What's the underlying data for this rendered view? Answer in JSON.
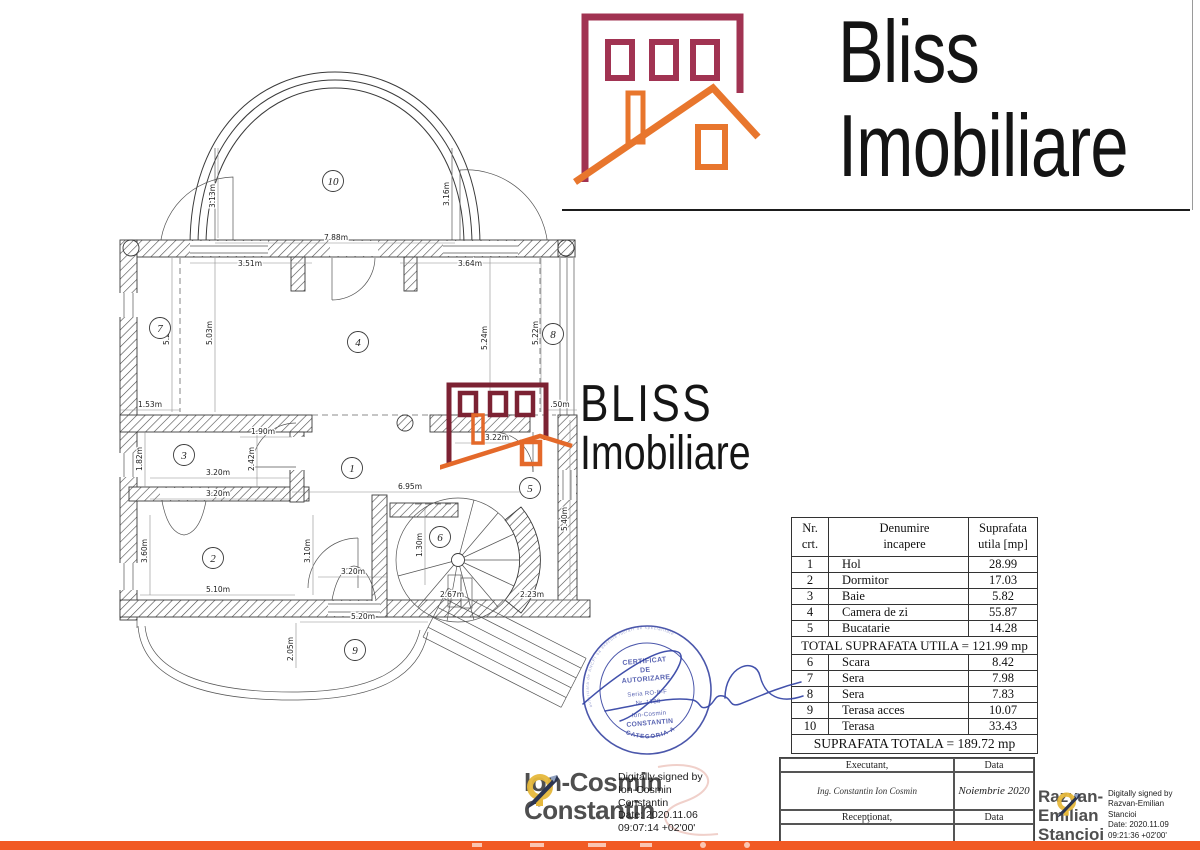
{
  "colors": {
    "maroon": "#a13352",
    "maroon_dark": "#7c2233",
    "orange": "#e8762d",
    "orange_dark": "#e4692a",
    "footer": "#f15a24",
    "stamp_blue": "#3340a0",
    "ink": "#2e3fa3"
  },
  "brand": {
    "line1": "Bliss",
    "line2": "Imobiliare"
  },
  "watermark": {
    "line1": "BLISS",
    "line2": "Imobiliare"
  },
  "floorplan": {
    "rooms": [
      {
        "n": "10",
        "x": 333,
        "y": 181
      },
      {
        "n": "7",
        "x": 160,
        "y": 328
      },
      {
        "n": "4",
        "x": 358,
        "y": 342
      },
      {
        "n": "8",
        "x": 553,
        "y": 334
      },
      {
        "n": "3",
        "x": 184,
        "y": 455
      },
      {
        "n": "1",
        "x": 352,
        "y": 468
      },
      {
        "n": "5",
        "x": 530,
        "y": 488
      },
      {
        "n": "2",
        "x": 213,
        "y": 558
      },
      {
        "n": "6",
        "x": 440,
        "y": 537
      },
      {
        "n": "9",
        "x": 355,
        "y": 650
      }
    ],
    "dims": [
      {
        "t": "7.88m",
        "x": 336,
        "y": 240,
        "r": 0
      },
      {
        "t": "3.51m",
        "x": 250,
        "y": 266,
        "r": 0
      },
      {
        "t": "3.64m",
        "x": 470,
        "y": 266,
        "r": 0
      },
      {
        "t": "3.13m",
        "x": 215,
        "y": 196,
        "r": -90
      },
      {
        "t": "3.16m",
        "x": 449,
        "y": 194,
        "r": -90
      },
      {
        "t": "5.22m",
        "x": 169,
        "y": 333,
        "r": -90
      },
      {
        "t": "5.03m",
        "x": 212,
        "y": 333,
        "r": -90
      },
      {
        "t": "5.24m",
        "x": 487,
        "y": 338,
        "r": -90
      },
      {
        "t": "5.22m",
        "x": 538,
        "y": 333,
        "r": -90
      },
      {
        "t": "1.53m",
        "x": 150,
        "y": 407,
        "r": 0
      },
      {
        "t": ".50m",
        "x": 560,
        "y": 407,
        "r": 0
      },
      {
        "t": "1.90m",
        "x": 263,
        "y": 434,
        "r": 0
      },
      {
        "t": "3.22m",
        "x": 497,
        "y": 440,
        "r": 0
      },
      {
        "t": "1.82m",
        "x": 142,
        "y": 459,
        "r": -90
      },
      {
        "t": "2.42m",
        "x": 254,
        "y": 459,
        "r": -90
      },
      {
        "t": "3.20m",
        "x": 218,
        "y": 475,
        "r": 0
      },
      {
        "t": "3.20m",
        "x": 218,
        "y": 496,
        "r": 0
      },
      {
        "t": "6.95m",
        "x": 410,
        "y": 489,
        "r": 0
      },
      {
        "t": "3.20m",
        "x": 353,
        "y": 574,
        "r": 0
      },
      {
        "t": "3.60m",
        "x": 147,
        "y": 551,
        "r": -90
      },
      {
        "t": "3.10m",
        "x": 310,
        "y": 551,
        "r": -90
      },
      {
        "t": "1.30m",
        "x": 422,
        "y": 545,
        "r": -90
      },
      {
        "t": "5.40m",
        "x": 567,
        "y": 519,
        "r": -90
      },
      {
        "t": "5.10m",
        "x": 218,
        "y": 592,
        "r": 0
      },
      {
        "t": "2.67m",
        "x": 452,
        "y": 597,
        "r": 0
      },
      {
        "t": "2.23m",
        "x": 532,
        "y": 597,
        "r": 0
      },
      {
        "t": "5.20m",
        "x": 363,
        "y": 619,
        "r": 0
      },
      {
        "t": "2.05m",
        "x": 293,
        "y": 649,
        "r": -90
      }
    ]
  },
  "area_table": {
    "headers": [
      "Nr.\ncrt.",
      "Denumire\nincapere",
      "Suprafata\nutila [mp]"
    ],
    "rows1": [
      [
        "1",
        "Hol",
        "28.99"
      ],
      [
        "2",
        "Dormitor",
        "17.03"
      ],
      [
        "3",
        "Baie",
        "5.82"
      ],
      [
        "4",
        "Camera de zi",
        "55.87"
      ],
      [
        "5",
        "Bucatarie",
        "14.28"
      ]
    ],
    "total1": "TOTAL SUPRAFATA UTILA = 121.99 mp",
    "rows2": [
      [
        "6",
        "Scara",
        "8.42"
      ],
      [
        "7",
        "Sera",
        "7.98"
      ],
      [
        "8",
        "Sera",
        "7.83"
      ],
      [
        "9",
        "Terasa acces",
        "10.07"
      ],
      [
        "10",
        "Terasa",
        "33.43"
      ]
    ],
    "total2": "SUPRAFATA TOTALA = 189.72 mp"
  },
  "stamp": {
    "lines": [
      "CERTIFICAT",
      "DE",
      "AUTORIZARE",
      "Seria RO-B-F",
      "Nr. 1788",
      "Ion-Cosmin",
      "CONSTANTIN"
    ],
    "categoria": "CATEGORIA A",
    "rim": "autorizata de ANCPI sa execute lucrari de specialitate"
  },
  "signature_left": {
    "name": "Ion-Cosmin\nConstantin",
    "details": "Digitally signed by\nIon-Cosmin\nConstantin\nDate: 2020.11.06\n09:07:14 +02'00'"
  },
  "signature_right": {
    "name": "Razvan-\nEmilian\nStancioi",
    "details": "Digitally signed by\nRazvan-Emilian\nStancioi\nDate: 2020.11.09\n09:21:36 +02'00'"
  },
  "exec_table": {
    "executant_label": "Executant,",
    "data_label1": "Data",
    "executant_value": "Ing. Constantin Ion Cosmin",
    "data_value": "Noiembrie 2020",
    "receptionat_label": "Recepţionat,",
    "data_label2": "Data"
  }
}
